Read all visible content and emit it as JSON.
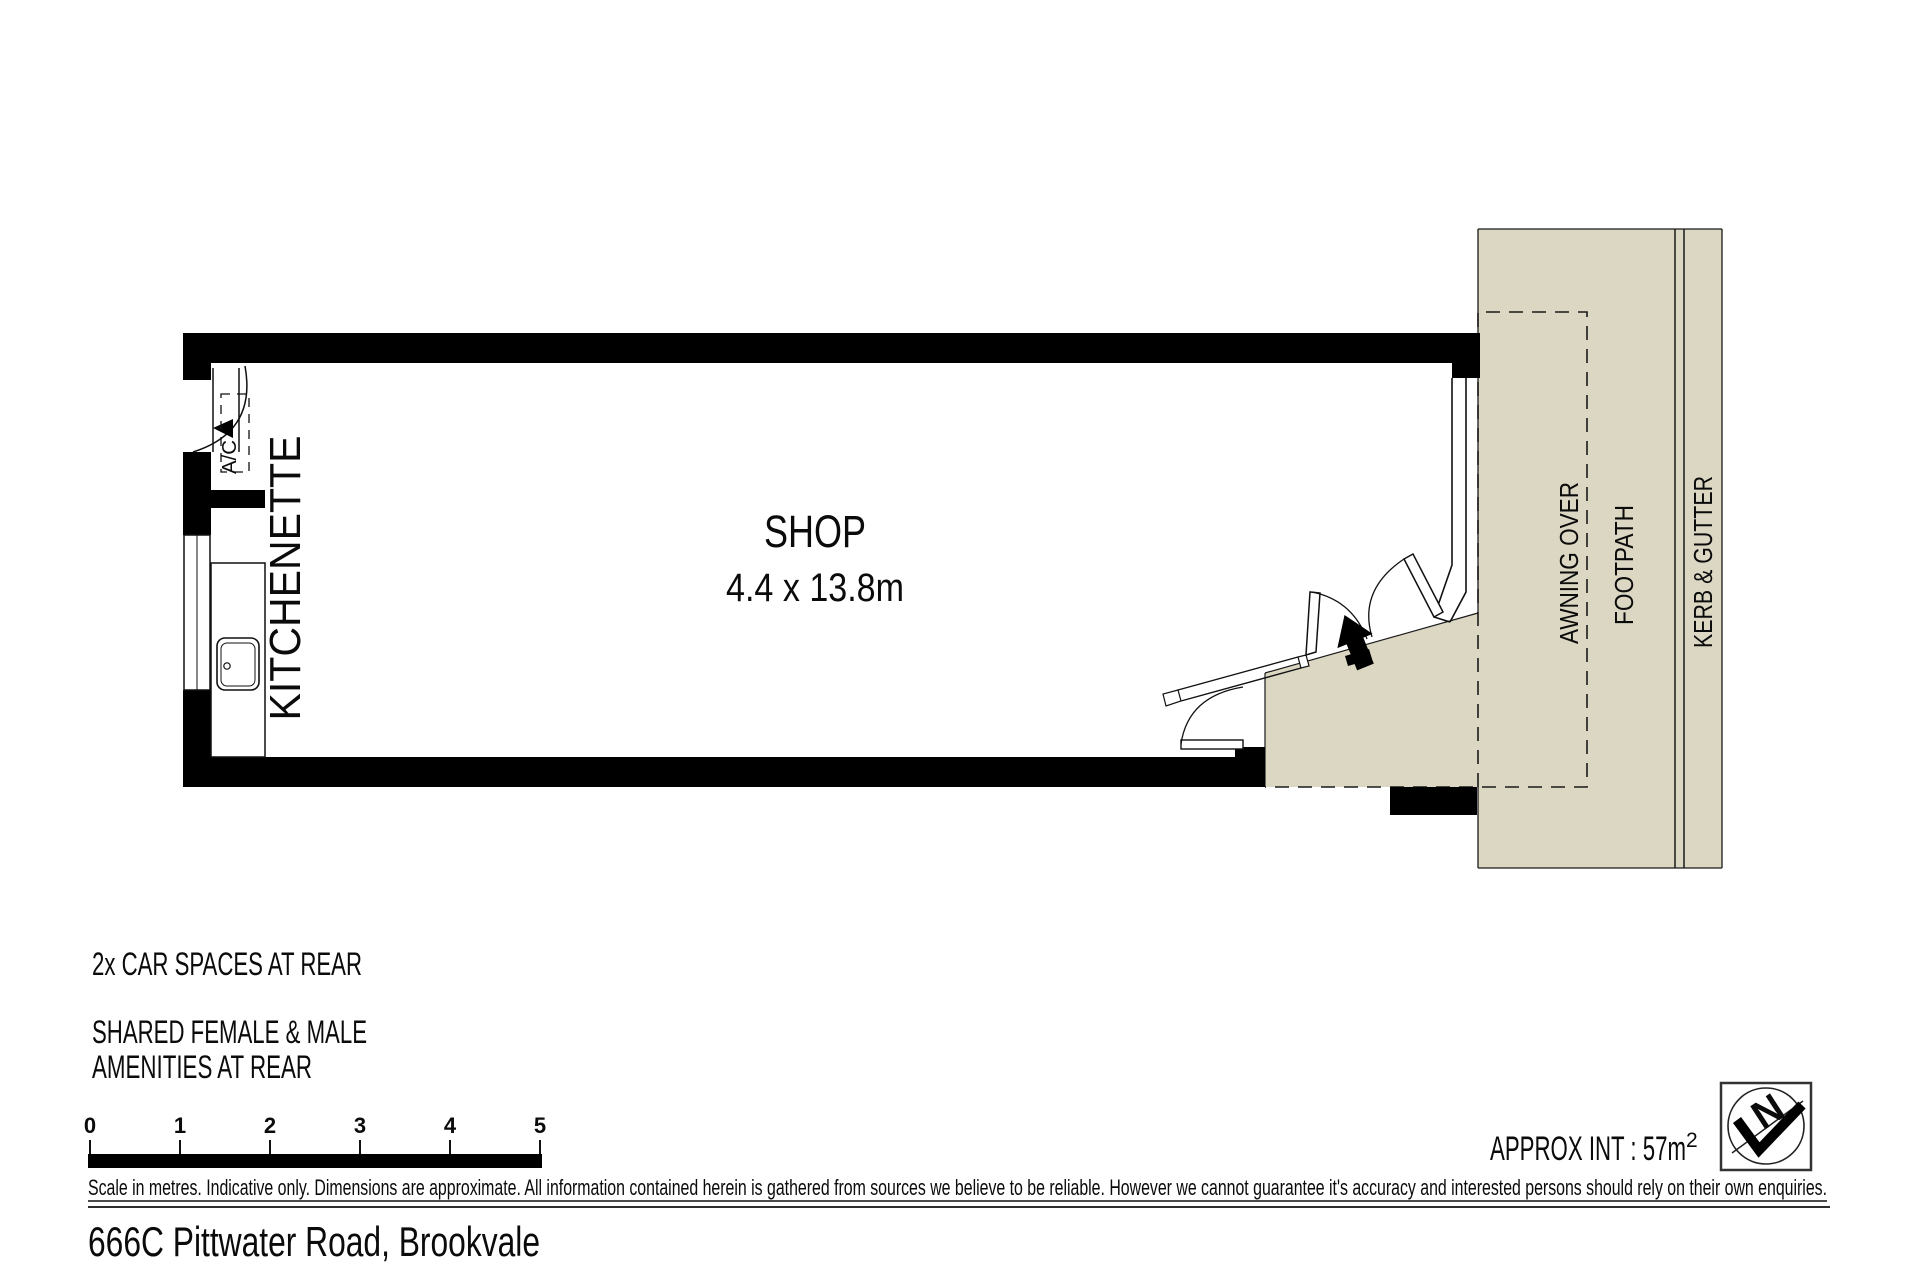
{
  "plan": {
    "room_label": "SHOP",
    "room_dimensions": "4.4 x 13.8m",
    "kitchenette_label": "KITCHENETTE",
    "ac_label": "A/C",
    "awning_label": "AWNING OVER",
    "footpath_label": "FOOTPATH",
    "kerb_label": "KERB & GUTTER"
  },
  "notes": {
    "car_spaces": "2x CAR SPACES AT REAR",
    "amenities_line_1": "SHARED FEMALE & MALE",
    "amenities_line_2": "AMENITIES AT REAR"
  },
  "scale_bar": {
    "ticks": [
      "0",
      "1",
      "2",
      "3",
      "4",
      "5"
    ]
  },
  "area": {
    "label": "APPROX INT : 57m",
    "superscript": "2"
  },
  "north": {
    "label": "N"
  },
  "disclaimer": "Scale in metres. Indicative only. Dimensions are approximate. All information contained herein is gathered from sources we believe to be reliable. However we cannot guarantee it's accuracy and interested persons should rely on their own enquiries.",
  "address": "666C Pittwater Road, Brookvale",
  "colors": {
    "paving": "#dbd7c3",
    "wall": "#000000"
  }
}
